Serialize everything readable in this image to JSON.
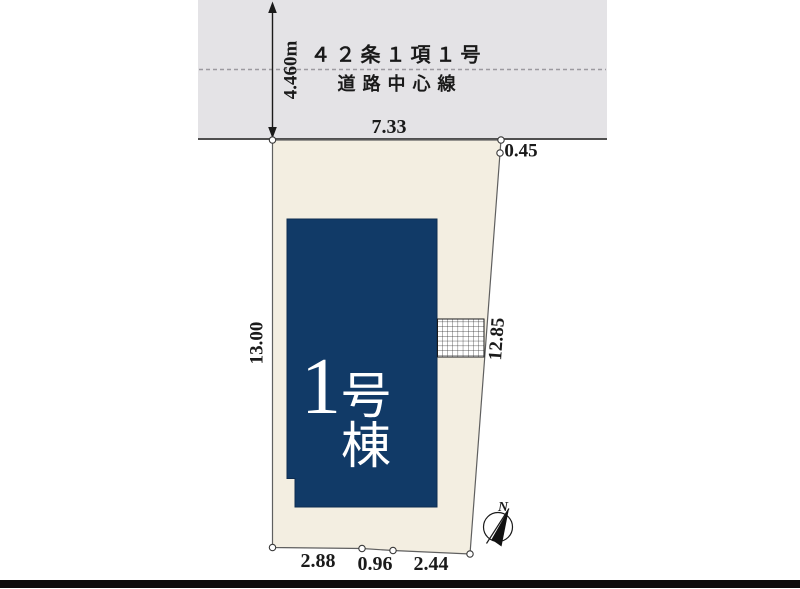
{
  "road": {
    "regulation_label": "４２条１項１号",
    "centerline_label": "道路中心線",
    "width_dimension": "4.460m"
  },
  "plot": {
    "dimensions": {
      "top": "7.33",
      "top_right": "0.45",
      "left": "13.00",
      "right": "12.85",
      "bottom_left": "2.88",
      "bottom_middle": "0.96",
      "bottom_right": "2.44"
    }
  },
  "building": {
    "number": "1",
    "suffix": "号棟"
  },
  "compass": {
    "north_label": "N"
  },
  "colors": {
    "road_fill": "#e4e3e6",
    "road_line": "#4f4f4f",
    "plot_fill": "#f3eee1",
    "plot_stroke": "#5f5f5f",
    "building_fill": "#113a67",
    "footer_bar": "#0d0d0d"
  }
}
